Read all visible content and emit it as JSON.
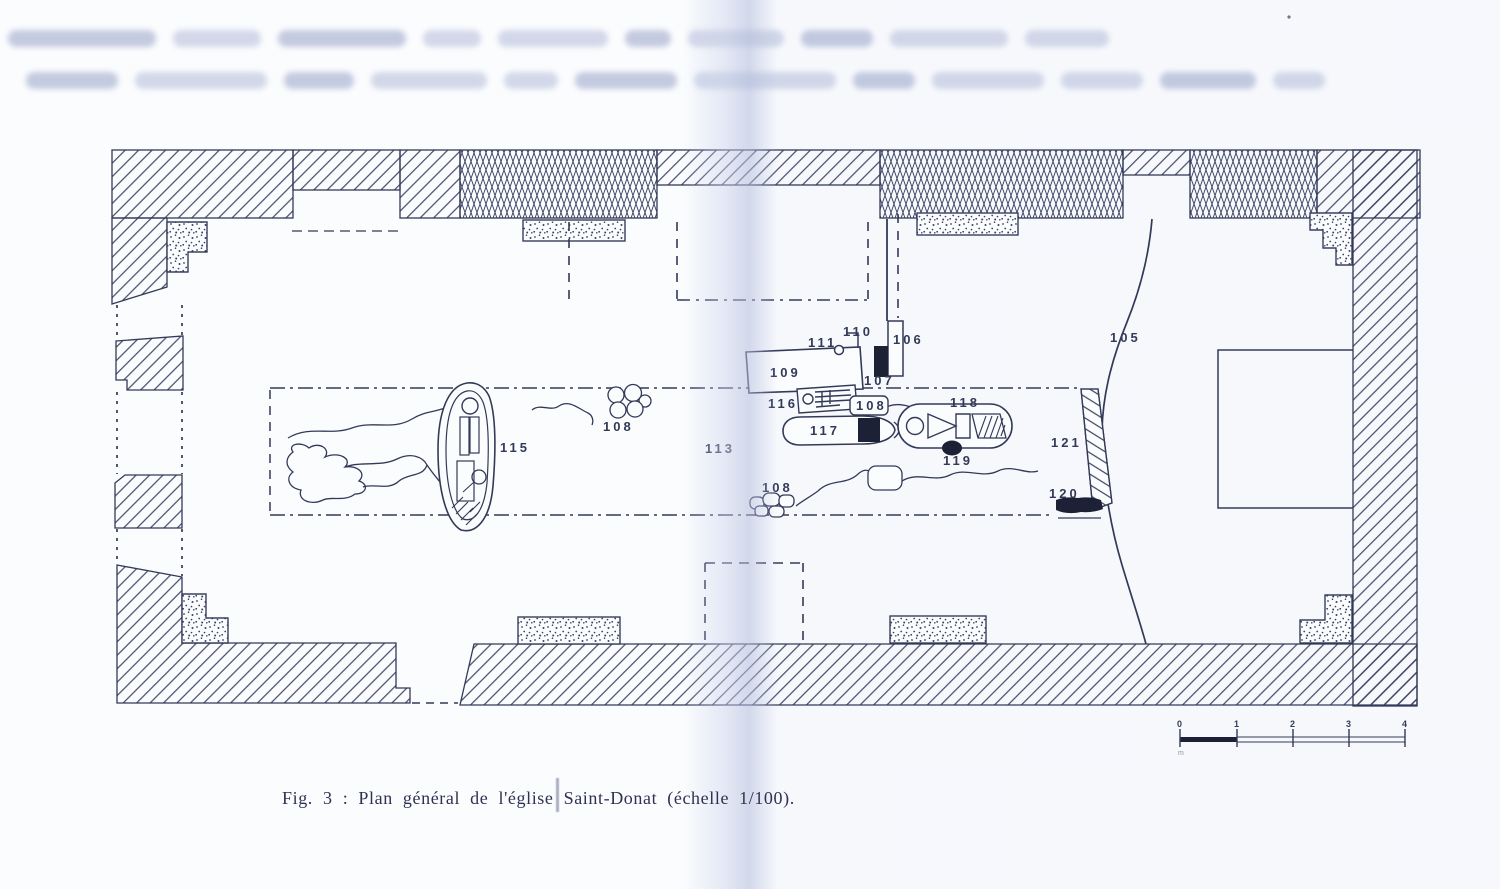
{
  "figure": {
    "caption": "Fig. 3 : Plan général de l'église Saint-Donat (échelle 1/100)."
  },
  "plan": {
    "labels": {
      "l105": "105",
      "l106": "106",
      "l107": "107",
      "l108a": "108",
      "l108b": "108",
      "l108c": "108",
      "l109": "109",
      "l110": "110",
      "l111": "111",
      "l113": "113",
      "l115": "115",
      "l116": "116",
      "l117": "117",
      "l118": "118",
      "l119": "119",
      "l120": "120",
      "l121": "121"
    }
  },
  "scale_bar": {
    "ticks": [
      "0",
      "1",
      "2",
      "3",
      "4"
    ],
    "unit_label": "m"
  },
  "scan": {
    "faded_header_line_count": 2
  },
  "colors": {
    "ink": "#333a58",
    "fill_black": "#1c2136",
    "paper": "#fbfcfe",
    "fold_tint": "#c9d2ea"
  }
}
